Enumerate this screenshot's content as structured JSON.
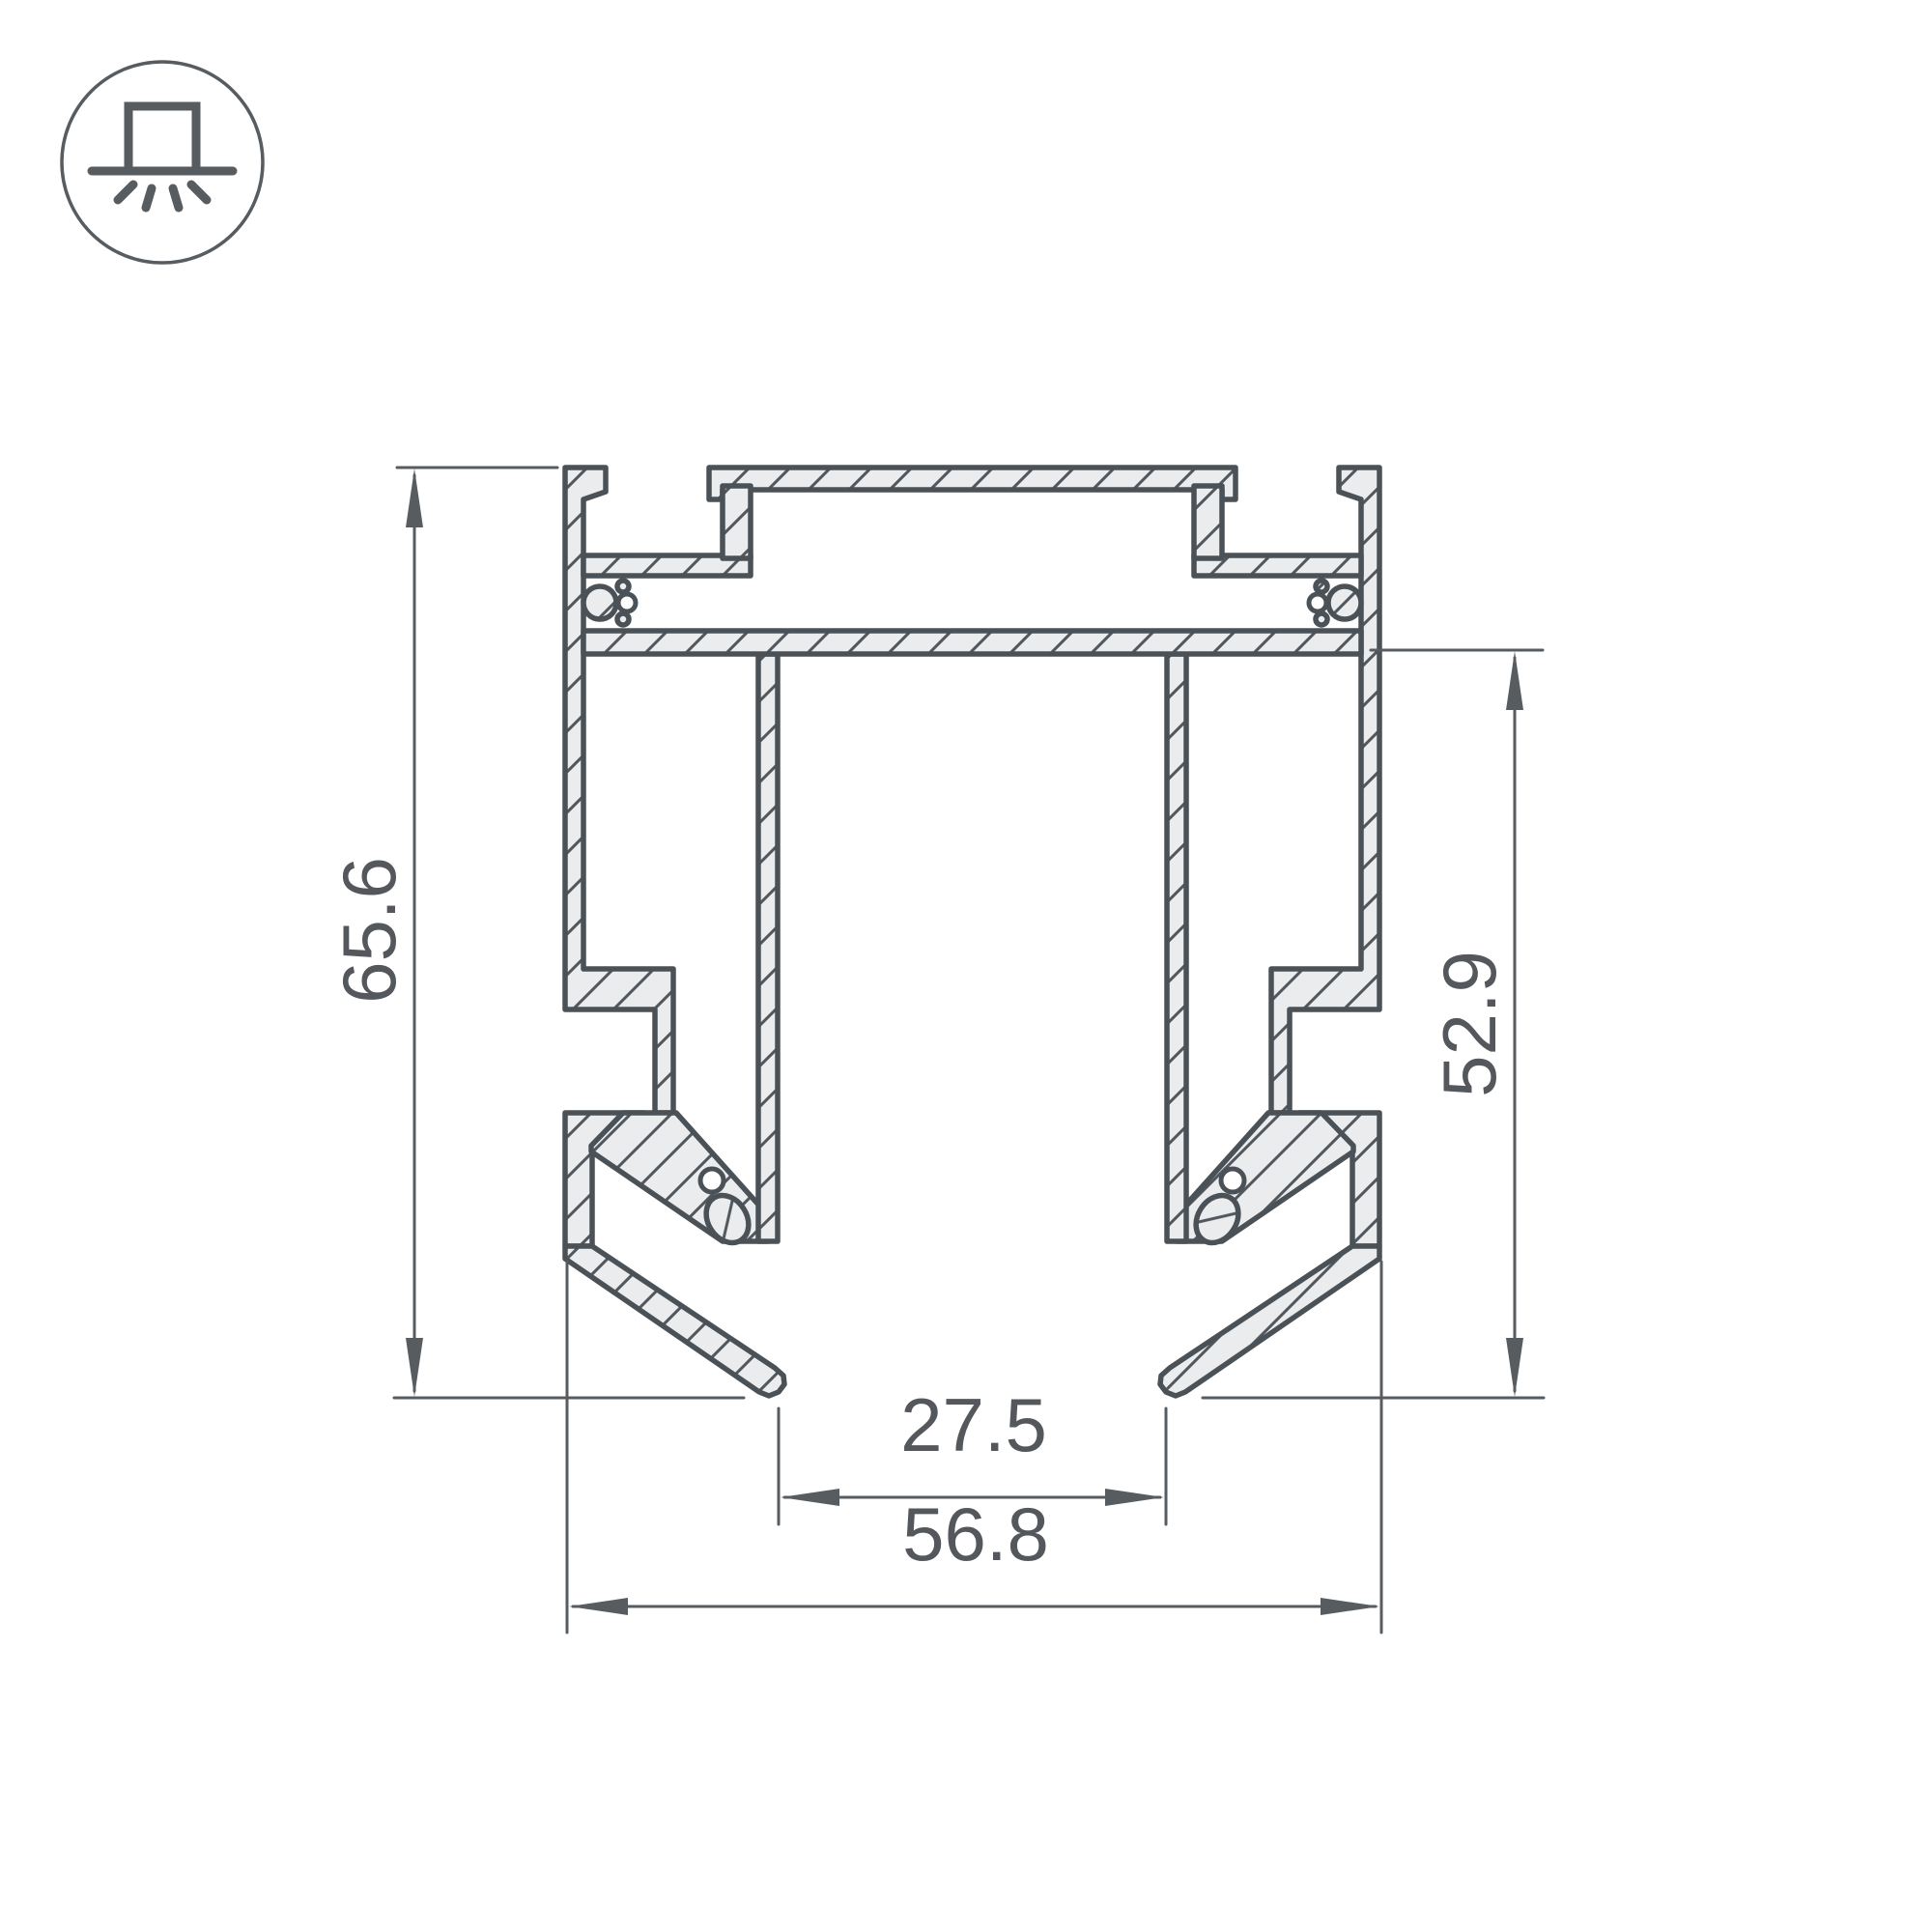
{
  "icon": {
    "name": "surface-mounted-luminaire-icon"
  },
  "dimensions": {
    "height_total": "65.6",
    "side_height": "52.9",
    "inner_width": "27.5",
    "outer_width": "56.8"
  },
  "colors": {
    "outline": "#4a5157",
    "metal_fill": "#ebeced",
    "hatch": "#51575d",
    "dimension_lines": "#575c61",
    "dimension_text": "#54585d",
    "background": "#ffffff"
  }
}
